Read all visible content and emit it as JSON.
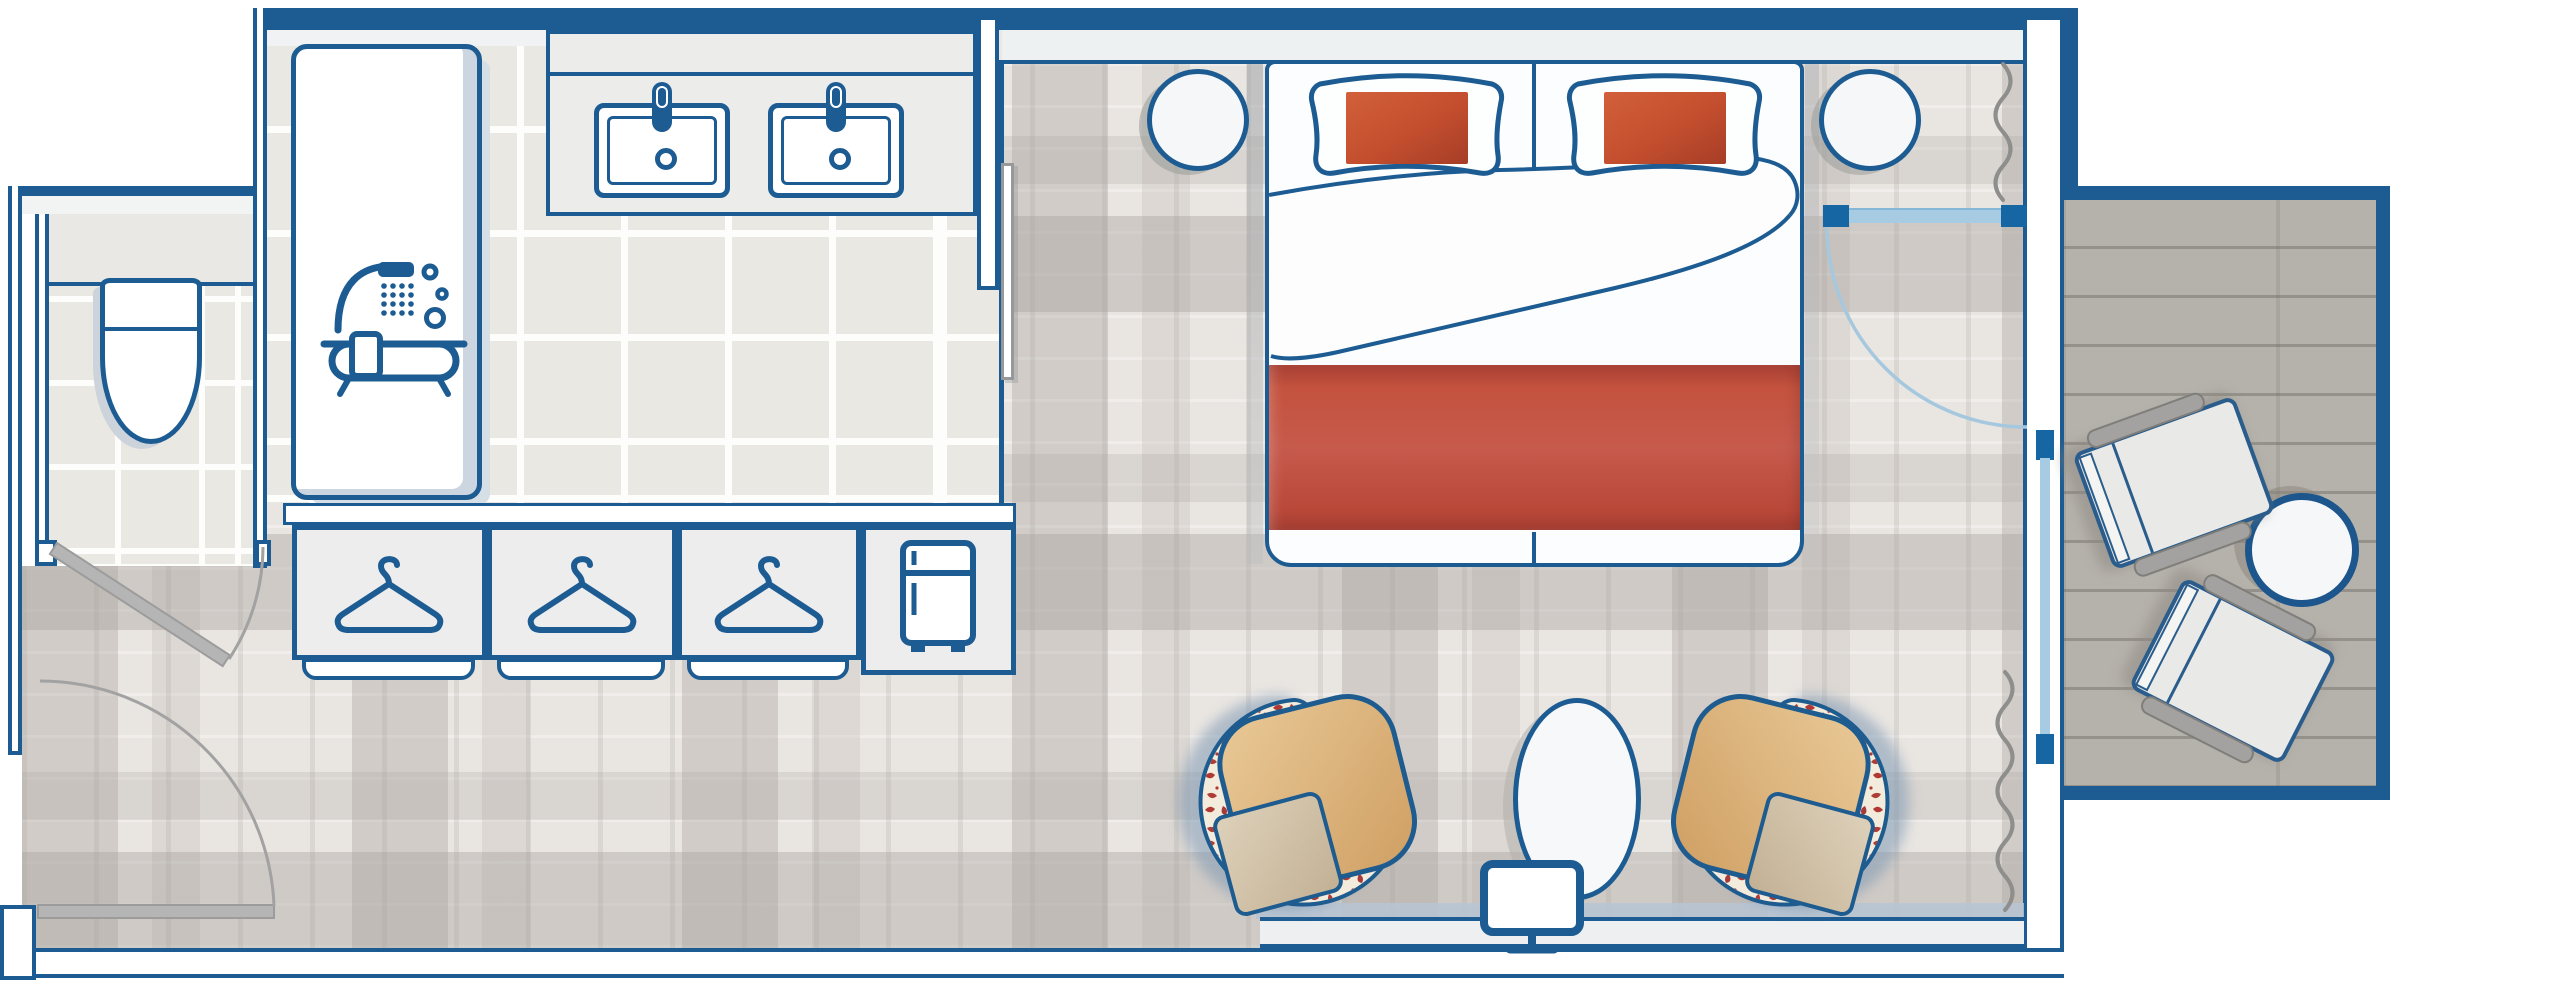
{
  "scene": {
    "title": "Hotel room floor plan",
    "type": "floor-plan"
  },
  "palette": {
    "wall_blue": "#1d5c92",
    "glass_blue": "#a6cbe2",
    "glass_cap_blue": "#1566a3",
    "pillow_red": "#c54f30",
    "runner_red": "#c24f3c",
    "cushion_tan": "#dcb67e",
    "floral_cream": "#f3ebdc",
    "floral_red": "#b03a33",
    "carpet_base": "#e9e5e1",
    "tile_base": "#eae8e3",
    "balcony_floor": "#b5b1ab",
    "steel_shadow": "#b6c4d3",
    "door_gray": "#b5b5b5"
  },
  "rooms": {
    "bathroom": {
      "label": "Bathroom",
      "items": [
        "bathtub-shower-icon",
        "sink",
        "sink",
        "faucet",
        "faucet",
        "vanity",
        "sliding-door"
      ]
    },
    "wc": {
      "label": "WC",
      "items": [
        "toilet",
        "swing-door"
      ]
    },
    "wardrobe": {
      "label": "Wardrobe",
      "items": [
        "hanger-icon",
        "hanger-icon",
        "hanger-icon",
        "minibar-fridge-icon"
      ]
    },
    "bedroom": {
      "label": "Bedroom",
      "items": [
        "double-bed",
        "pillow",
        "pillow",
        "red-cushion",
        "red-cushion",
        "red-runner",
        "duvet",
        "nightstand",
        "nightstand",
        "armchair",
        "armchair",
        "oval-table",
        "tv-icon",
        "media-console",
        "curtain",
        "curtain",
        "glass-door"
      ]
    },
    "balcony": {
      "label": "Balcony",
      "items": [
        "lounge-chair",
        "lounge-chair",
        "round-table",
        "window"
      ]
    },
    "entry": {
      "label": "Entry",
      "items": [
        "entry-door"
      ]
    }
  },
  "counts": {
    "hangers": 3,
    "sinks": 2,
    "armchairs": 2,
    "balcony_chairs": 2,
    "nightstands": 2,
    "pillows": 2
  }
}
